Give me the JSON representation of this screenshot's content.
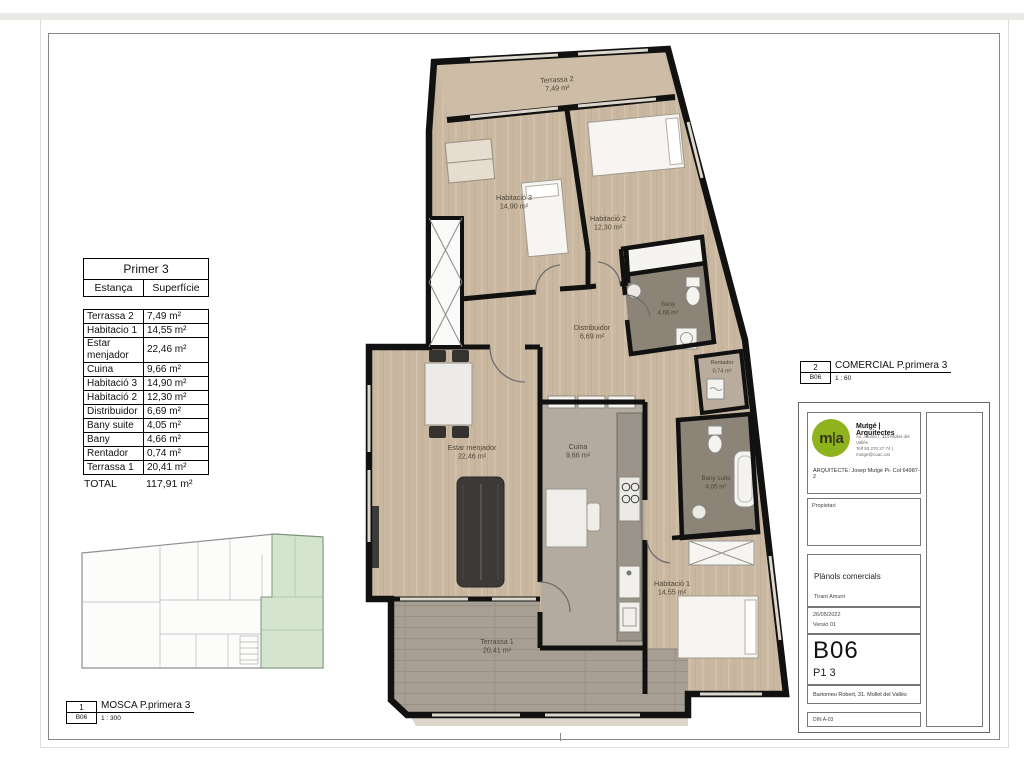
{
  "surface_table": {
    "title": "Primer 3",
    "col_room": "Estança",
    "col_area": "Superfície",
    "rows": [
      {
        "name": "Terrassa 2",
        "area": "7,49 m²"
      },
      {
        "name": "Habitacio 1",
        "area": "14,55 m²"
      },
      {
        "name": "Estar menjador",
        "area": "22,46 m²"
      },
      {
        "name": "Cuina",
        "area": "9,66 m²"
      },
      {
        "name": "Habitació 3",
        "area": "14,90 m²"
      },
      {
        "name": "Habitació 2",
        "area": "12,30 m²"
      },
      {
        "name": "Distribuidor",
        "area": "6,69 m²"
      },
      {
        "name": "Bany suite",
        "area": "4,05 m²"
      },
      {
        "name": "Bany",
        "area": "4,66 m²"
      },
      {
        "name": "Rentador",
        "area": "0,74 m²"
      },
      {
        "name": "Terrassa 1",
        "area": "20,41 m²"
      }
    ],
    "total_label": "TOTAL",
    "total_area": "117,91 m²"
  },
  "plan": {
    "rooms": [
      {
        "id": "terrassa-2",
        "label": "Terrassa 2",
        "area": "7,49 m²"
      },
      {
        "id": "habitacio-3",
        "label": "Habitació 3",
        "area": "14,90 m²"
      },
      {
        "id": "habitacio-2",
        "label": "Habitació 2",
        "area": "12,30 m²"
      },
      {
        "id": "bany",
        "label": "Bany",
        "area": "4,66 m²"
      },
      {
        "id": "distribuidor",
        "label": "Distribuidor",
        "area": "6,69 m²"
      },
      {
        "id": "rentador",
        "label": "Rentador",
        "area": "0,74 m²"
      },
      {
        "id": "estar-menjador",
        "label": "Estar menjador",
        "area": "22,46 m²"
      },
      {
        "id": "cuina",
        "label": "Cuina",
        "area": "9,66 m²"
      },
      {
        "id": "bany-suite",
        "label": "Bany suite",
        "area": "4,05 m²"
      },
      {
        "id": "habitacio-1",
        "label": "Habitació 1",
        "area": "14,55 m²"
      },
      {
        "id": "terrassa-1",
        "label": "Terrassa 1",
        "area": "20,41 m²"
      }
    ]
  },
  "callout_mosca": {
    "number": "1",
    "title": "MOSCA P.primera 3",
    "code": "B06",
    "scale": "1 : 300"
  },
  "callout_comercial": {
    "number": "2",
    "title": "COMERCIAL P.primera 3",
    "code": "B06",
    "scale": "1 : 60"
  },
  "title_block": {
    "logo_text_left": "m",
    "logo_text_right": "a",
    "brand": "Mutgé | Arquitectes",
    "address_line1": "Av. Jaume I, 114 Mollet del Vallès",
    "address_line2": "Telf 93 270 27 74 | mutge@coac.cat",
    "architect": "ARQUITECTE: Josep Mutgé Pi- Col 64987-2",
    "owner_label": "Propietari",
    "project": "Plànols comercials",
    "project_sub": "Tirant Amunt",
    "date": "26/05/2022",
    "version": "Versió 01",
    "sheet_code": "B06",
    "sheet_sub": "P1 3",
    "site_address": "Bartomeu Robert, 31. Mollet del Vallès",
    "format": "DIN A-03"
  },
  "colors": {
    "logo_green": "#8fb31d",
    "unit_highlight": "#d5e4cf",
    "wall": "#111111",
    "wood_floor": "#c9b7a0",
    "terrace_floor": "#a79f93",
    "bath_floor": "#8d8478"
  }
}
